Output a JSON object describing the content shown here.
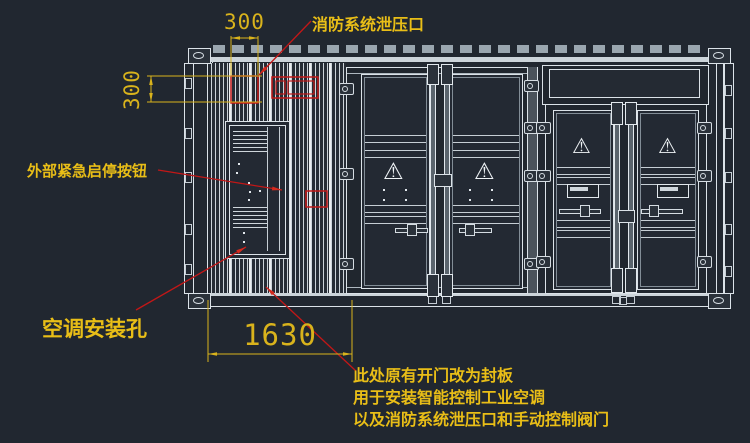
{
  "drawing": {
    "type": "container-equipment-elevation",
    "background_color": "#212730",
    "line_color": "#dbe2e8",
    "annotation_color": "#e9be17",
    "dimension_color": "#d9b31c",
    "marker_color": "#c21717"
  },
  "dimensions": {
    "top_width": "300",
    "left_height": "300",
    "bottom_width": "1630"
  },
  "annotations": {
    "fire_relief": {
      "label": "消防系统泄压口"
    },
    "emergency_button": {
      "label": "外部紧急启停按钮"
    },
    "aircon_hole": {
      "label": "空调安装孔"
    },
    "seal_note": {
      "lines": [
        "此处原有开门改为封板",
        "用于安装智能控制工业空调",
        "以及消防系统泄压口和手动控制阀门"
      ]
    }
  },
  "icons": {
    "hazard_triangle": "⚠"
  }
}
